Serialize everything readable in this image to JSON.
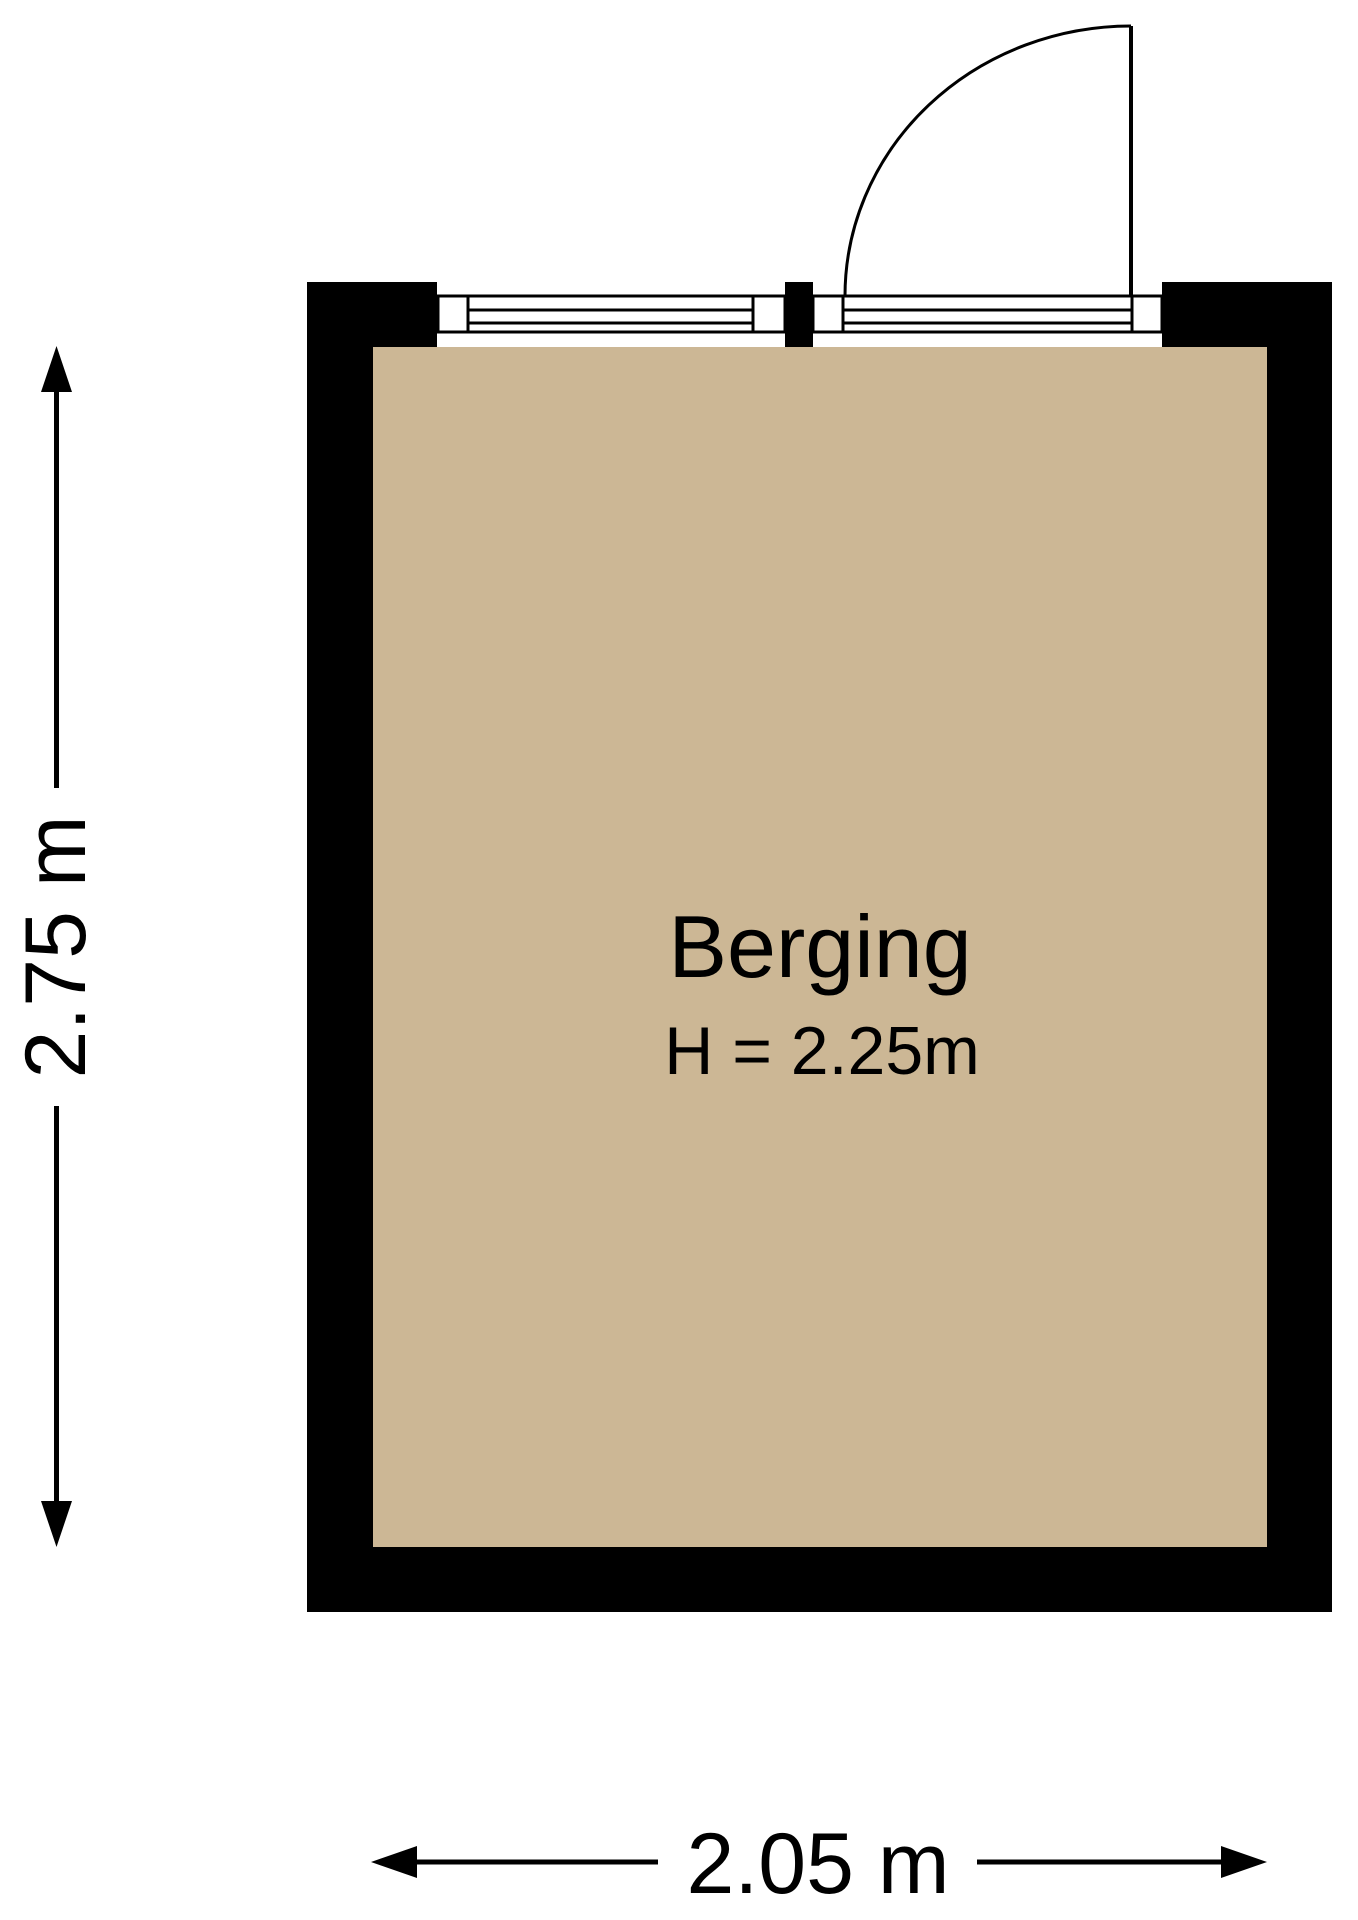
{
  "floorplan": {
    "room": {
      "name": "Berging",
      "height_label": "H = 2.25m"
    },
    "dimensions": {
      "vertical": "2.75 m",
      "horizontal": "2.05 m"
    },
    "colors": {
      "floor": "#CCB795",
      "wall": "#000000",
      "background": "#FFFFFF",
      "line": "#000000"
    },
    "symbols": {
      "door": "quarter-circle-swing-arc-top-right",
      "window": "triple-lined-band",
      "dimension_arrow": "double-headed-arrow"
    }
  }
}
